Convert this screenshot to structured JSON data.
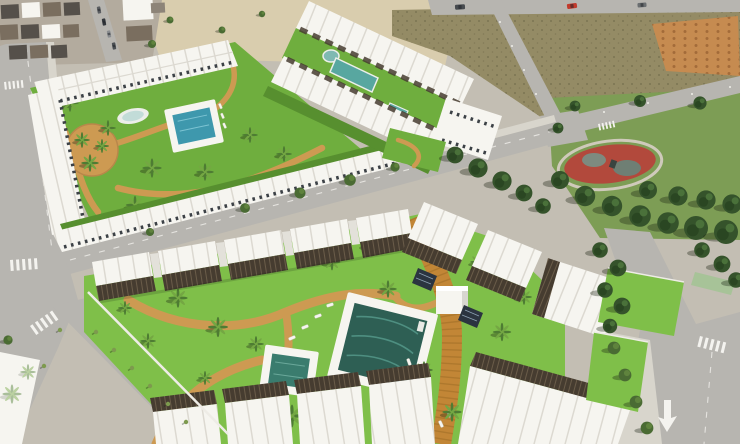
{
  "scene": {
    "description": "Aerial 3D render of a new-build residential development: white townhouse and apartment complexes with communal gardens, swimming pools and palm trees, beside an existing town, vacant plots and a public park with a red playground.",
    "features": {
      "existing_town": "existing-town",
      "sand_plaza": "sand-plaza",
      "vacant_lots": "vacant-lots",
      "dirt_mounds": "dirt-mounds",
      "public_park": "public-park",
      "playground": "red-playground",
      "phase1_complex": "townhouse-complex-northwest",
      "phase1_pool": "community-pool-blue",
      "phase1_fountain": "oval-fountain",
      "phase2_complex": "townhouse-complex-north",
      "phase2_lap_pool": "linear-lap-pool",
      "phase2_plunge_pool": "plunge-pool",
      "phase3_complex": "apartment-complex-main",
      "main_pool": "main-swimming-pool",
      "kids_pool": "kids-pool",
      "boardwalk": "timber-boardwalk",
      "pavilion": "pool-pavilion-cube",
      "solar_panels": "solar-panels",
      "roads": "perimeter-roads",
      "crosswalks": "zebra-crossings",
      "road_arrow": "lane-arrow",
      "red_car": "red-car"
    },
    "counts": {
      "pools_visible": 6,
      "complexes": 3
    }
  },
  "colors": {
    "base": "#c3beb3",
    "road": "#b7b5b0",
    "sidewalk": "#d8d5cc",
    "sand": "#d9cdae",
    "ground-town": "#b3ab9e",
    "lot": "#948b65",
    "dirt-orange": "#c68b50",
    "park-grass": "#7d9d55",
    "grass": "#6fae3e",
    "grass-bright": "#7fbf49",
    "grass-dark": "#578f2f",
    "path-tan": "#cd9a52",
    "boardwalk": "#c28636",
    "boardwalk-plank": "#9e6d27",
    "pool-main": "#2e5f54",
    "pool-ripple": "#4e8f81",
    "pool-kids": "#3a7c6e",
    "pool-blue": "#3e98ad",
    "pool-long": "#58a7a0",
    "bldg-white": "#f6f5f0",
    "bldg-line": "#dcd9d1",
    "bldg-shade": "#d8d6cf",
    "slat-dark": "#463c30",
    "slat-light": "#6a5c49",
    "window": "#3c4146",
    "roof-dark": "#55504a",
    "roof-brown": "#7a6e5f",
    "tree": "#4a6b33",
    "tree-light": "#6e9344",
    "pine": "#35532b",
    "palm": "#4e7c33",
    "palm-light": "#74a743",
    "playground-red": "#b2493c",
    "marking": "#f4f3ef",
    "car-red": "#c23a2c",
    "shadow": "rgba(25,35,18,0.35)"
  }
}
